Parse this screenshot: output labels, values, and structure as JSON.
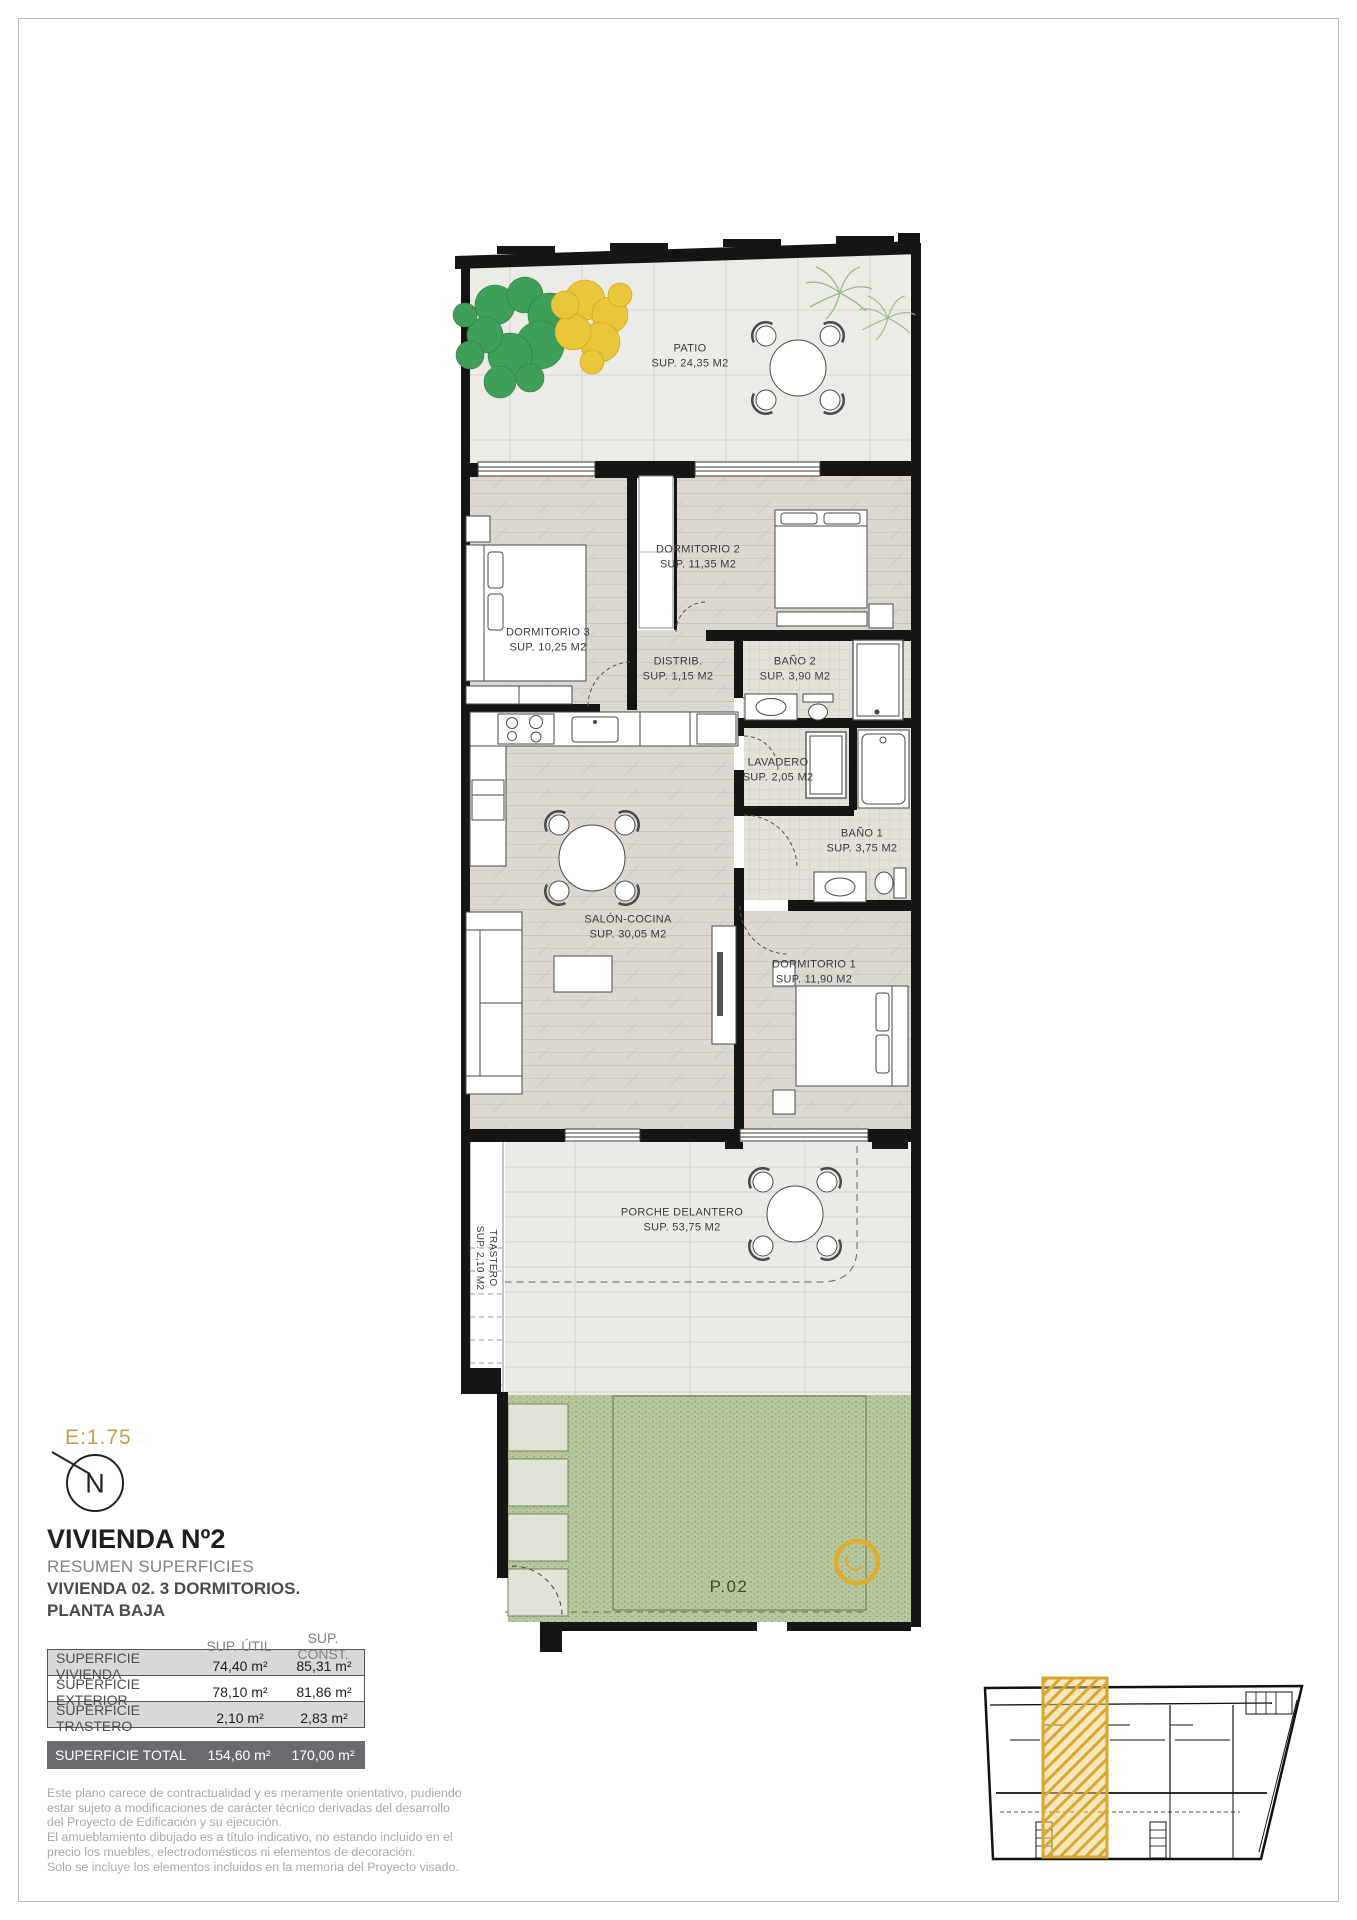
{
  "scale_label": "E:1.75",
  "north": {
    "label": "N"
  },
  "title_block": {
    "title": "VIVIENDA Nº2",
    "subtitle": "RESUMEN SUPERFICIES",
    "line2": "VIVIENDA 02. 3 DORMITORIOS.",
    "line3": "PLANTA BAJA"
  },
  "areas_table": {
    "col_headers": [
      "SUP. ÚTIL",
      "SUP. CONST."
    ],
    "rows": [
      {
        "label": "SUPERFICIE VIVIENDA",
        "util": "74,40 m²",
        "const": "85,31 m²"
      },
      {
        "label": "SUPERFICIE EXTERIOR",
        "util": "78,10 m²",
        "const": "81,86 m²"
      },
      {
        "label": "SUPERFICIE TRASTERO",
        "util": "2,10 m²",
        "const": "2,83 m²"
      }
    ],
    "total": {
      "label": "SUPERFICIE TOTAL",
      "util": "154,60 m²",
      "const": "170,00 m²"
    }
  },
  "notes": [
    "Este plano carece de contractualidad y es meramente orientativo, pudiendo",
    "estar sujeto a modificaciones de carácter técnico derivadas del desarrollo",
    "del Proyecto de Edificación y su ejecución.",
    "El amueblamiento dibujado es a título indicativo, no estando incluido en el",
    "precio los muebles, electrodomésticos ni elementos de decoración.",
    "Solo se incluye los elementos incluidos en la memoria del Proyecto visado."
  ],
  "rooms": [
    {
      "name": "PATIO",
      "sup": "SUP. 24,35 M2"
    },
    {
      "name": "DORMITORIO 2",
      "sup": "SUP. 11,35 M2"
    },
    {
      "name": "DORMITORIO 3",
      "sup": "SUP. 10,25 M2"
    },
    {
      "name": "DISTRIB.",
      "sup": "SUP. 1,15 M2"
    },
    {
      "name": "BAÑO 2",
      "sup": "SUP. 3,90 M2"
    },
    {
      "name": "LAVADERO",
      "sup": "SUP. 2,05 M2"
    },
    {
      "name": "BAÑO 1",
      "sup": "SUP. 3,75 M2"
    },
    {
      "name": "SALÓN-COCINA",
      "sup": "SUP. 30,05 M2"
    },
    {
      "name": "DORMITORIO 1",
      "sup": "SUP. 11,90 M2"
    },
    {
      "name": "PORCHE DELANTERO",
      "sup": "SUP. 53,75 M2"
    },
    {
      "name": "TRASTERO",
      "sup": "SUP. 2,10 M2"
    }
  ],
  "plot_label": "P.02",
  "colors": {
    "accent_gold": "#d9a62e",
    "wall_black": "#151515",
    "garden_green": "#b9c79e",
    "tree_green": "#3f9e58",
    "tree_yellow": "#eac63b",
    "palm_green": "#9cb98b",
    "table_total_bg": "#6a6b6f",
    "table_stripe": "#d7d8d9"
  }
}
